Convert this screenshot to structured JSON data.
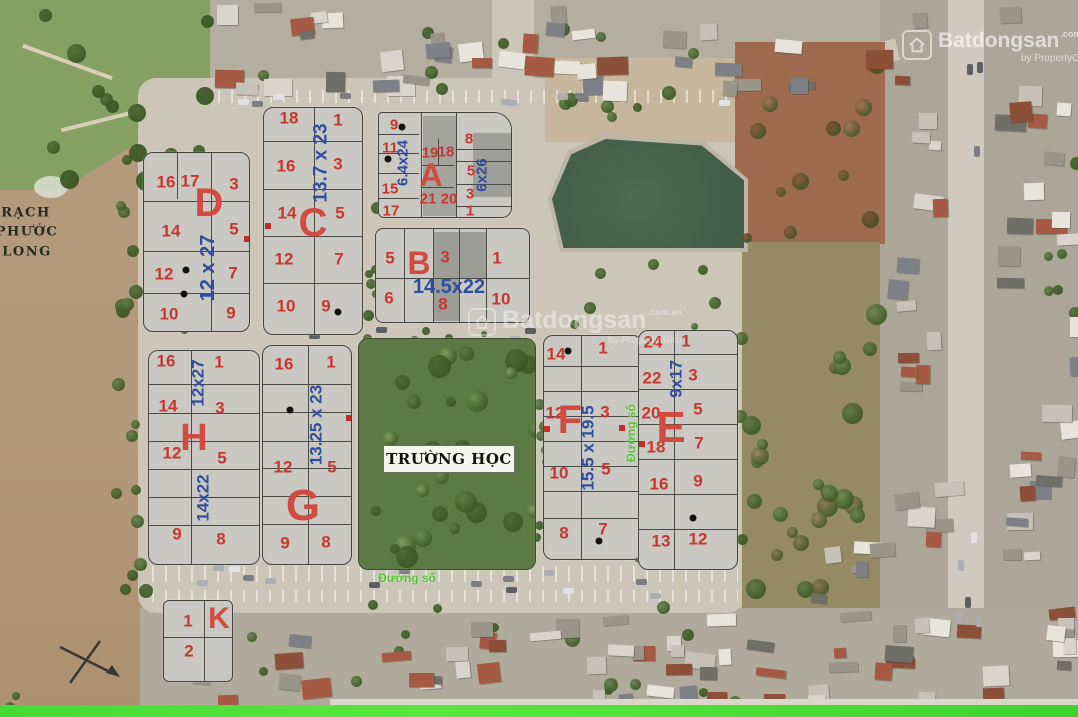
{
  "watermark": {
    "brand": "Batdongsan",
    "domain": ".com.vn",
    "byline": "by PropertyGuru"
  },
  "map_labels": {
    "river_line1": "RẠCH",
    "river_line2": "PHƯỚC",
    "river_line3": "LONG",
    "school": "TRƯỜNG HỌC",
    "road_label": "Đường số"
  },
  "blocks": {
    "d": {
      "letter": "D",
      "dim": "12 x 27",
      "plots": [
        "16",
        "17",
        "3",
        "14",
        "5",
        "12",
        "7",
        "10",
        "9"
      ]
    },
    "c": {
      "letter": "C",
      "dim": "13.7 x 23",
      "plots": [
        "18",
        "1",
        "16",
        "3",
        "14",
        "5",
        "12",
        "7",
        "10",
        "9"
      ]
    },
    "a": {
      "letter": "A",
      "dim_left": "6.4x24",
      "dim_right": "6x26",
      "plots": [
        "9",
        "11",
        "15",
        "17",
        "19",
        "18",
        "21",
        "20",
        "8",
        "5",
        "3",
        "1"
      ]
    },
    "b": {
      "letter": "B",
      "dim": "14.5x22",
      "plots": [
        "5",
        "3",
        "1",
        "6",
        "8",
        "10"
      ]
    },
    "h": {
      "letter": "H",
      "dim_top": "12x27",
      "dim_bottom": "14x22",
      "plots": [
        "16",
        "1",
        "14",
        "3",
        "12",
        "5",
        "9",
        "8"
      ]
    },
    "g": {
      "letter": "G",
      "dim": "13.25 x 23",
      "plots": [
        "16",
        "1",
        "12",
        "5",
        "9",
        "8"
      ]
    },
    "f": {
      "letter": "F",
      "dim": "15.5 x 19.5",
      "plots": [
        "14",
        "1",
        "12",
        "3",
        "10",
        "5",
        "8",
        "7"
      ]
    },
    "e": {
      "letter": "E",
      "dim": "9x17",
      "plots": [
        "24",
        "1",
        "22",
        "3",
        "20",
        "5",
        "18",
        "7",
        "16",
        "9",
        "13",
        "12"
      ]
    },
    "k": {
      "letter": "K",
      "plots": [
        "1",
        "2"
      ]
    }
  }
}
